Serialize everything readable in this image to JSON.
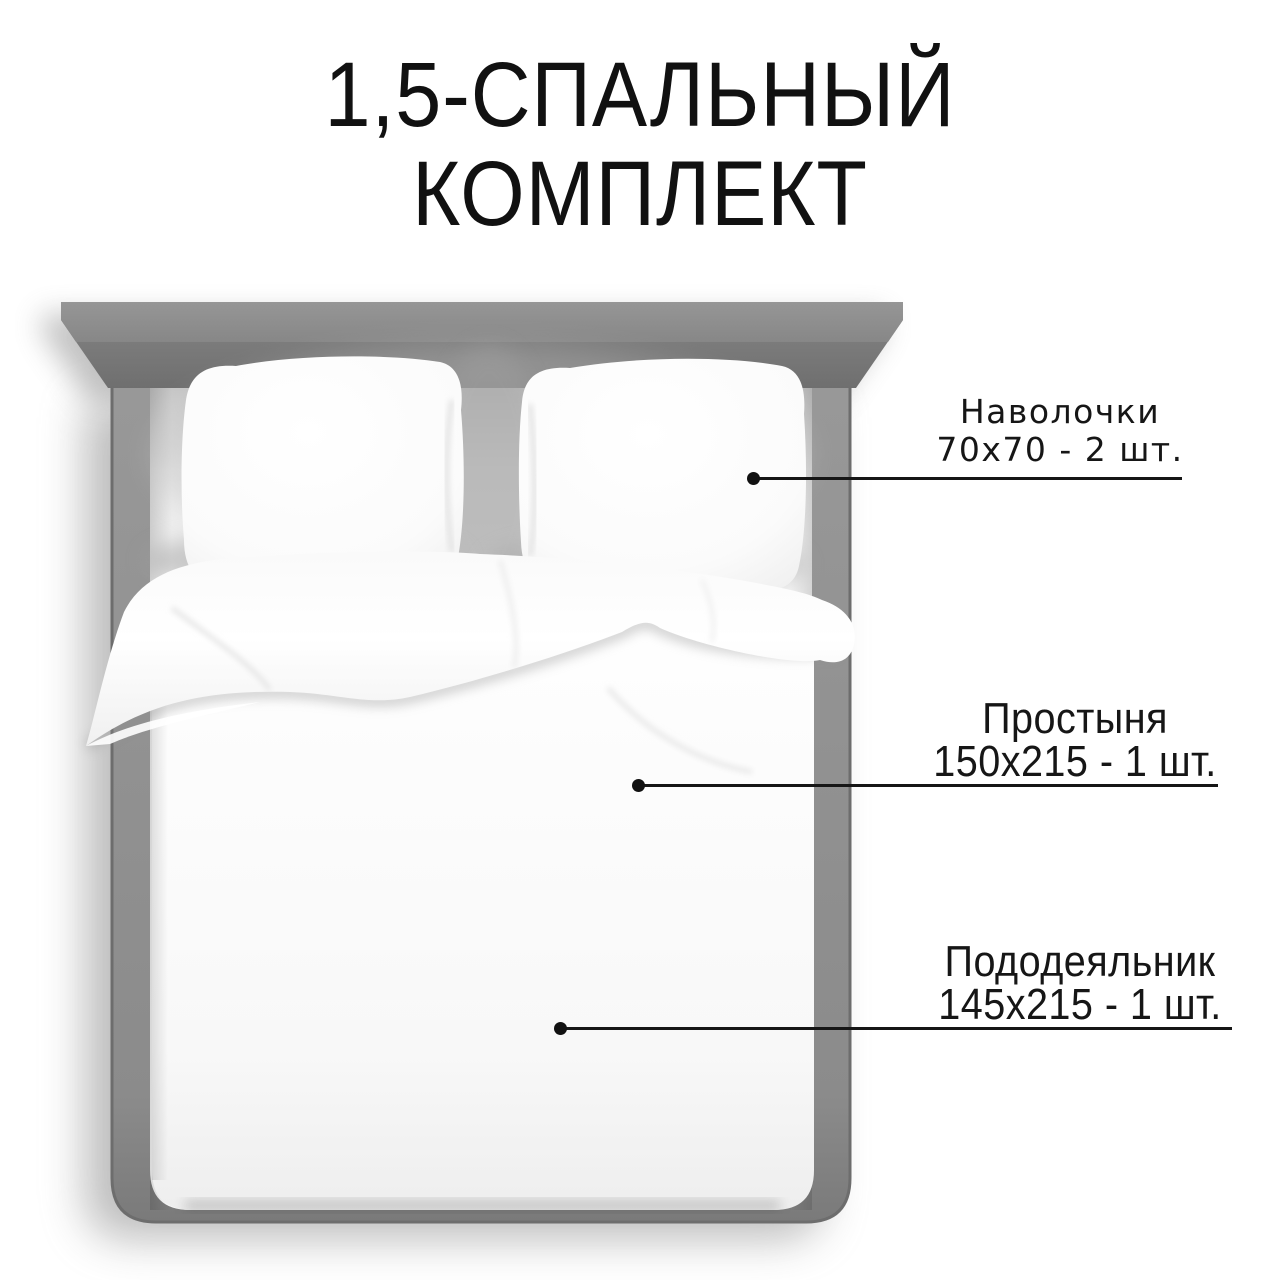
{
  "page": {
    "background_color": "#ffffff",
    "text_color": "#161616"
  },
  "title": {
    "line1": "1,5-СПАЛЬНЫЙ",
    "line2": "КОМПЛЕКТ"
  },
  "callouts": [
    {
      "item": "Наволочки",
      "size": "70х70 - 2 шт."
    },
    {
      "item": "Простыня",
      "size": "150х215 - 1 шт."
    },
    {
      "item": "Пододеяльник",
      "size": "145х215 - 1 шт."
    }
  ],
  "illustration": {
    "kind": "top-down view of a bed with white bedding set",
    "colors": {
      "headboard_gray": "#8a8a8a",
      "frame_gray": "#8d8d8d",
      "frame_edge": "#6d6d6d",
      "bedding_white": "#ffffff",
      "shadow_gray": "#7a7a7a",
      "callout_line": "#161616"
    }
  }
}
